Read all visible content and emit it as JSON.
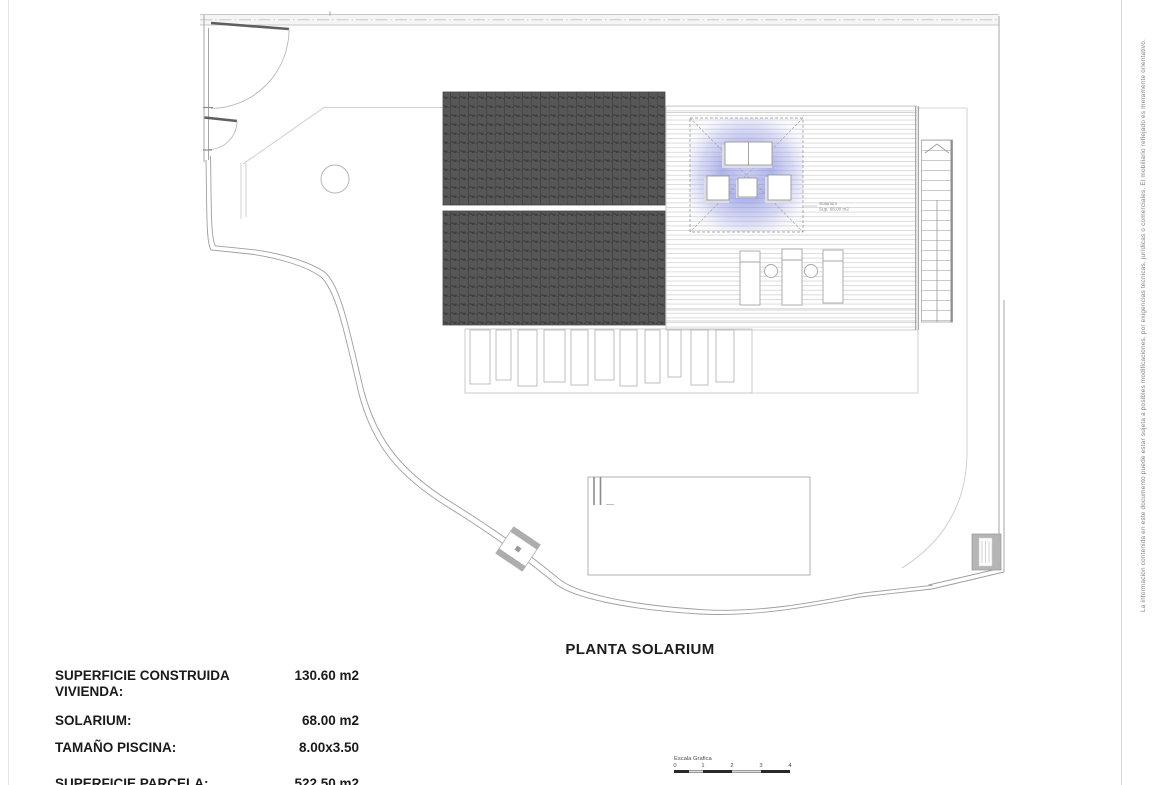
{
  "disclaimer": "La información contenida en este documento puede estar sujeta a posibles modificaciones, por exigencias técnicas, jurídicas o comerciales. El mobiliario reflejado es meramente orientativo.",
  "plan": {
    "title": "PLANTA SOLARIUM",
    "solarium_label_line1": "Solarium",
    "solarium_label_line2": "Sup. 68.00 m2"
  },
  "specs": {
    "rows": [
      {
        "label": "SUPERFICIE CONSTRUIDA VIVIENDA:",
        "value": "130.60 m2"
      },
      {
        "label": "SOLARIUM:",
        "value": "68.00 m2"
      },
      {
        "label": "TAMAÑO PISCINA:",
        "value": "8.00x3.50"
      },
      {
        "label": "SUPERFICIE PARCELA:",
        "value": "522.50 m2"
      }
    ]
  },
  "scale_bar": {
    "label": "Escala Grafica",
    "ticks": [
      "0",
      "1",
      "2",
      "3",
      "4"
    ]
  },
  "colors": {
    "roof_tile": "#575757",
    "roof_tile_line": "#3a3a3a",
    "lounge_glow": "#7f87dd",
    "plan_line": "#a0a0a0",
    "scale_dark": "#2a2a2a"
  }
}
